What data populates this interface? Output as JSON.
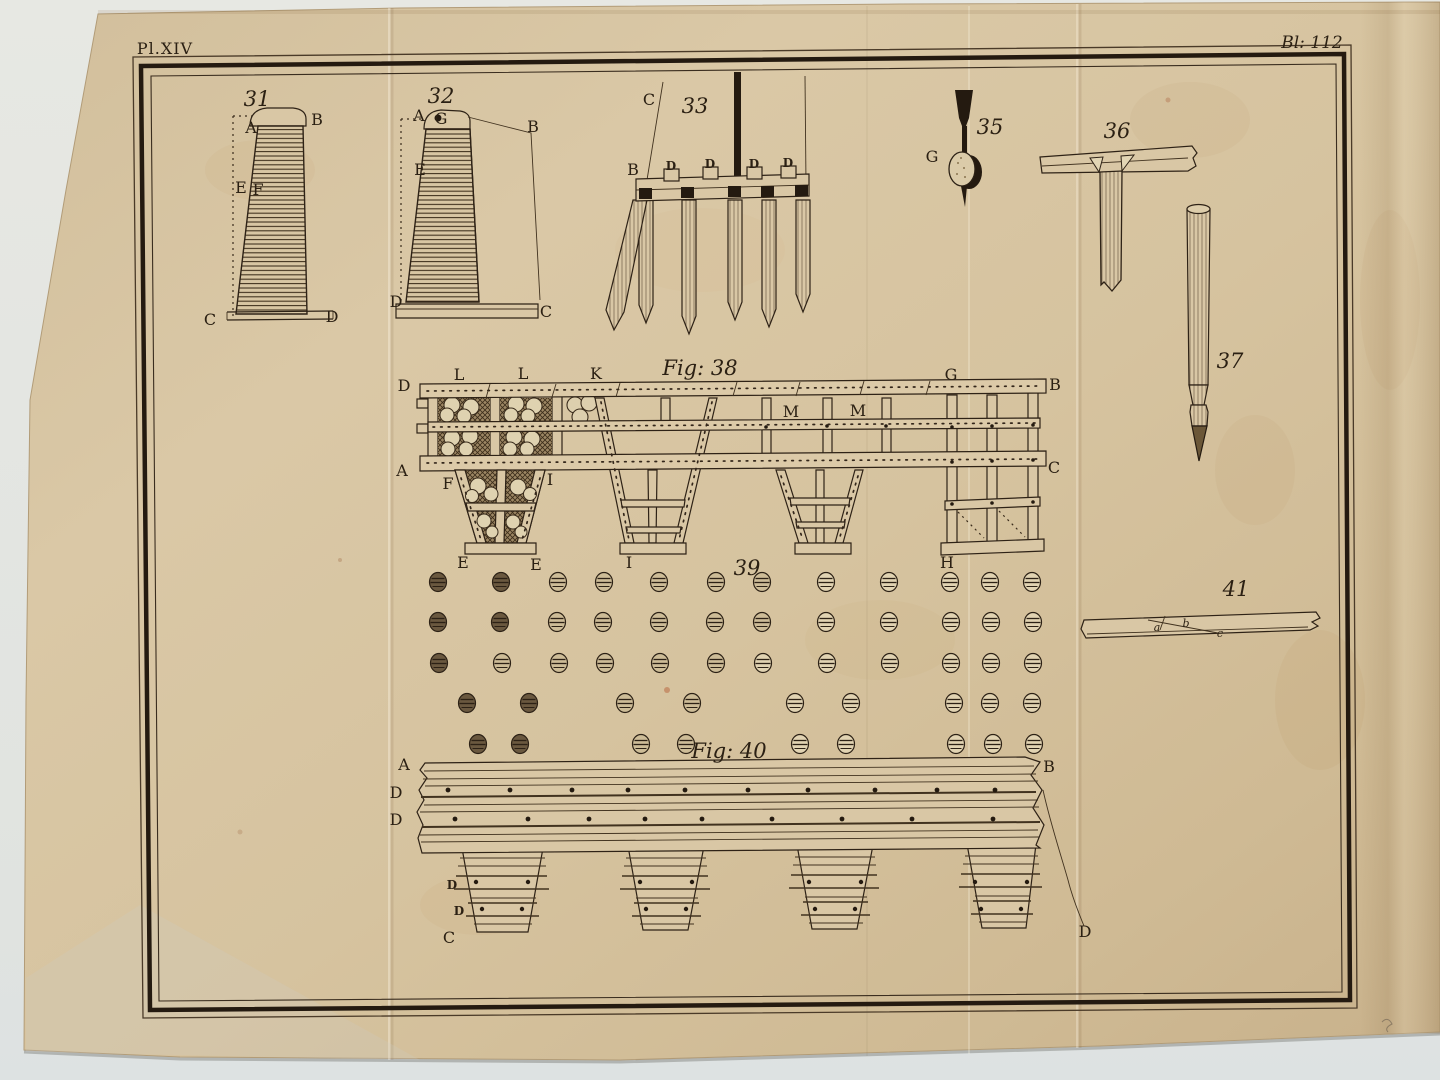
{
  "plate": {
    "plate_number": "Pl.XIV",
    "page_number": "Bl: 112"
  },
  "labels": [
    {
      "t": "31",
      "x": 257,
      "y": 106,
      "s": "num"
    },
    {
      "t": "A",
      "x": 251,
      "y": 133,
      "s": "cap"
    },
    {
      "t": "B",
      "x": 317,
      "y": 125,
      "s": "cap"
    },
    {
      "t": "E",
      "x": 241,
      "y": 193,
      "s": "cap"
    },
    {
      "t": "F",
      "x": 258,
      "y": 195,
      "s": "cap"
    },
    {
      "t": "C",
      "x": 210,
      "y": 325,
      "s": "cap"
    },
    {
      "t": "D",
      "x": 332,
      "y": 322,
      "s": "cap"
    },
    {
      "t": "32",
      "x": 441,
      "y": 103,
      "s": "num"
    },
    {
      "t": "A",
      "x": 419,
      "y": 121,
      "s": "cap"
    },
    {
      "t": "G",
      "x": 441,
      "y": 124,
      "s": "cap"
    },
    {
      "t": "B",
      "x": 533,
      "y": 132,
      "s": "cap"
    },
    {
      "t": "E",
      "x": 420,
      "y": 175,
      "s": "cap"
    },
    {
      "t": "D",
      "x": 396,
      "y": 307,
      "s": "cap"
    },
    {
      "t": "C",
      "x": 546,
      "y": 317,
      "s": "cap"
    },
    {
      "t": "33",
      "x": 695,
      "y": 113,
      "s": "num"
    },
    {
      "t": "C",
      "x": 649,
      "y": 105,
      "s": "cap"
    },
    {
      "t": "B",
      "x": 633,
      "y": 175,
      "s": "cap"
    },
    {
      "t": "D",
      "x": 671,
      "y": 170,
      "s": "capsm"
    },
    {
      "t": "D",
      "x": 710,
      "y": 168,
      "s": "capsm"
    },
    {
      "t": "D",
      "x": 754,
      "y": 168,
      "s": "capsm"
    },
    {
      "t": "D",
      "x": 788,
      "y": 167,
      "s": "capsm"
    },
    {
      "t": "35",
      "x": 990,
      "y": 134,
      "s": "num"
    },
    {
      "t": "G",
      "x": 932,
      "y": 162,
      "s": "cap"
    },
    {
      "t": "36",
      "x": 1117,
      "y": 138,
      "s": "num"
    },
    {
      "t": "37",
      "x": 1230,
      "y": 368,
      "s": "num"
    },
    {
      "t": "Fig: 38",
      "x": 700,
      "y": 375,
      "s": "title"
    },
    {
      "t": "D",
      "x": 404,
      "y": 391,
      "s": "cap"
    },
    {
      "t": "L",
      "x": 459,
      "y": 380,
      "s": "cap"
    },
    {
      "t": "L",
      "x": 523,
      "y": 379,
      "s": "cap"
    },
    {
      "t": "K",
      "x": 596,
      "y": 379,
      "s": "cap"
    },
    {
      "t": "G",
      "x": 951,
      "y": 380,
      "s": "cap"
    },
    {
      "t": "B",
      "x": 1055,
      "y": 390,
      "s": "cap"
    },
    {
      "t": "A",
      "x": 402,
      "y": 476,
      "s": "cap"
    },
    {
      "t": "F",
      "x": 448,
      "y": 489,
      "s": "cap"
    },
    {
      "t": "I",
      "x": 550,
      "y": 485,
      "s": "cap"
    },
    {
      "t": "C",
      "x": 1054,
      "y": 473,
      "s": "cap"
    },
    {
      "t": "M",
      "x": 791,
      "y": 417,
      "s": "cap"
    },
    {
      "t": "M",
      "x": 858,
      "y": 416,
      "s": "cap"
    },
    {
      "t": "E",
      "x": 463,
      "y": 568,
      "s": "cap"
    },
    {
      "t": "E",
      "x": 536,
      "y": 570,
      "s": "cap"
    },
    {
      "t": "I",
      "x": 629,
      "y": 568,
      "s": "cap"
    },
    {
      "t": "H",
      "x": 947,
      "y": 568,
      "s": "cap"
    },
    {
      "t": "39",
      "x": 747,
      "y": 575,
      "s": "num"
    },
    {
      "t": "Fig: 40",
      "x": 729,
      "y": 758,
      "s": "title"
    },
    {
      "t": "A",
      "x": 404,
      "y": 770,
      "s": "cap"
    },
    {
      "t": "B",
      "x": 1049,
      "y": 772,
      "s": "cap"
    },
    {
      "t": "D",
      "x": 396,
      "y": 798,
      "s": "cap"
    },
    {
      "t": "D",
      "x": 396,
      "y": 825,
      "s": "cap"
    },
    {
      "t": "D",
      "x": 452,
      "y": 889,
      "s": "capsm"
    },
    {
      "t": "D",
      "x": 459,
      "y": 915,
      "s": "capsm"
    },
    {
      "t": "C",
      "x": 449,
      "y": 943,
      "s": "cap"
    },
    {
      "t": "D",
      "x": 1085,
      "y": 937,
      "s": "cap"
    },
    {
      "t": "41",
      "x": 1236,
      "y": 596,
      "s": "num"
    },
    {
      "t": "a",
      "x": 1157,
      "y": 631,
      "s": "low"
    },
    {
      "t": "b",
      "x": 1186,
      "y": 627,
      "s": "low"
    },
    {
      "t": "c",
      "x": 1220,
      "y": 637,
      "s": "low"
    }
  ],
  "fig39": {
    "rows": [
      {
        "y": 582,
        "xs": [
          438,
          501,
          558,
          604,
          659,
          716,
          762,
          826,
          889,
          950,
          990,
          1032
        ],
        "shades": [
          0,
          0,
          1,
          1,
          1,
          1,
          1,
          2,
          2,
          2,
          2,
          2
        ]
      },
      {
        "y": 622,
        "xs": [
          438,
          500,
          557,
          603,
          659,
          715,
          762,
          826,
          889,
          951,
          991,
          1033
        ],
        "shades": [
          0,
          0,
          1,
          1,
          1,
          1,
          1,
          2,
          2,
          2,
          2,
          2
        ]
      },
      {
        "y": 663,
        "xs": [
          439,
          502,
          559,
          605,
          660,
          716,
          763,
          827,
          890,
          951,
          991,
          1033
        ],
        "shades": [
          0,
          1,
          1,
          1,
          1,
          1,
          2,
          2,
          2,
          2,
          2,
          2
        ]
      },
      {
        "y": 703,
        "xs": [
          467,
          529,
          625,
          692,
          795,
          851,
          954,
          990,
          1032
        ],
        "shades": [
          0,
          0,
          1,
          1,
          2,
          2,
          2,
          2,
          2
        ]
      },
      {
        "y": 744,
        "xs": [
          478,
          520,
          641,
          686,
          800,
          846,
          956,
          993,
          1034
        ],
        "shades": [
          0,
          0,
          1,
          1,
          2,
          2,
          2,
          2,
          2
        ]
      }
    ]
  },
  "fig40": {
    "bolt_rows": [
      {
        "y": 790,
        "xs": [
          448,
          510,
          572,
          628,
          685,
          748,
          808,
          875,
          937,
          995
        ]
      },
      {
        "y": 819,
        "xs": [
          455,
          528,
          589,
          645,
          702,
          772,
          842,
          912,
          993
        ]
      }
    ],
    "leg_centers": [
      502,
      666,
      835,
      1001
    ],
    "leg_dot_rows": [
      {
        "y": 882,
        "off": 26
      },
      {
        "y": 909,
        "off": 20
      }
    ]
  }
}
